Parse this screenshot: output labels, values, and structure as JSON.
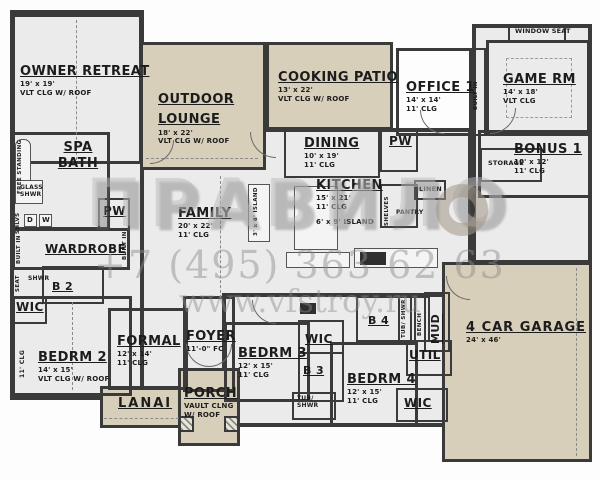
{
  "watermark": {
    "brand": "ПРАВИЛО",
    "phone": "+7 (495) 363 62 63",
    "site": "www.vfstroy.ru"
  },
  "colors": {
    "wall": "#3a3a3a",
    "interior": "#ebebeb",
    "outdoor": "#d8cfba",
    "text": "#1c1c1c"
  },
  "rooms": {
    "owner_retreat": {
      "name": "OWNER RETREAT",
      "dims": "19' x 19'",
      "ceiling": "VLT CLG W/ ROOF"
    },
    "spa_bath": {
      "name": "SPA BATH"
    },
    "free_standing": "FREE STANDING",
    "glass_shwr": "GLASS SHWR",
    "shlvs": "SHLVS",
    "built_in_left": "BUILT IN",
    "built_in_right": "BUILT IN",
    "built_in_office": "BUILT IN",
    "washer": "W",
    "dryer": "D",
    "wardrobe": "WARDROBE",
    "pw_left": "PW",
    "pw_dining": "PW",
    "seat": "SEAT",
    "shwr": "SHWR",
    "b2": "B 2",
    "wic2": "WIC",
    "bedrm2": {
      "name": "BEDRM 2",
      "dims": "14' x 15'",
      "ceiling": "VLT CLG W/ ROOF",
      "side": "11' CLG"
    },
    "formal": {
      "name": "FORMAL",
      "dims": "12' x 14'",
      "ceiling": "11' CLG"
    },
    "foyer": {
      "name": "FOYER",
      "ceiling": "11'-0\" FC"
    },
    "lanai": {
      "name": "LANAI"
    },
    "porch": {
      "name": "PORCH",
      "ceiling": "VAULT CLNG W/ ROOF"
    },
    "bedrm3": {
      "name": "BEDRM 3",
      "dims": "12' x 15'",
      "ceiling": "11' CLG"
    },
    "wic3": "WIC",
    "b3": "B 3",
    "tub_shwr3": "TUB/ SHWR",
    "bedrm4": {
      "name": "BEDRM 4",
      "dims": "12' x 15'",
      "ceiling": "11' CLG"
    },
    "b4": "B 4",
    "tub_shwr4": "TUB/ SHWR",
    "bench": "BENCH",
    "mud": "MUD",
    "util": "UTIL",
    "wic4": "WIC",
    "garage": {
      "name": "4 CAR GARAGE",
      "dims": "24' x 46'"
    },
    "outdoor_lounge": {
      "name": "OUTDOOR LOUNGE",
      "dims": "18' x 22'",
      "ceiling": "VLT CLG W/ ROOF"
    },
    "cooking_patio": {
      "name": "COOKING PATIO",
      "dims": "13' x 22'",
      "ceiling": "VLT CLG W/ ROOF"
    },
    "dining": {
      "name": "DINING",
      "dims": "10' x 19'",
      "ceiling": "11' CLG"
    },
    "kitchen": {
      "name": "KITCHEN",
      "dims": "15' x 21'",
      "ceiling": "11' CLG",
      "island": "6' x 9' ISLAND"
    },
    "island_small": "3' x 8' ISLAND",
    "family": {
      "name": "FAMILY",
      "dims": "20' x 22'",
      "ceiling": "11' CLG"
    },
    "office1": {
      "name": "OFFICE 1",
      "dims": "14' x 14'",
      "ceiling": "11' CLG"
    },
    "game_rm": {
      "name": "GAME RM",
      "dims": "14' x 18'",
      "ceiling": "VLT CLG"
    },
    "window_seat": "WINDOW SEAT",
    "bonus1": {
      "name": "BONUS 1",
      "dims": "10' x 12'",
      "ceiling": "11' CLG"
    },
    "storage": "STORAGE",
    "linen": "LINEN",
    "shelves": "SHELVES",
    "pantry": "PANTRY"
  }
}
